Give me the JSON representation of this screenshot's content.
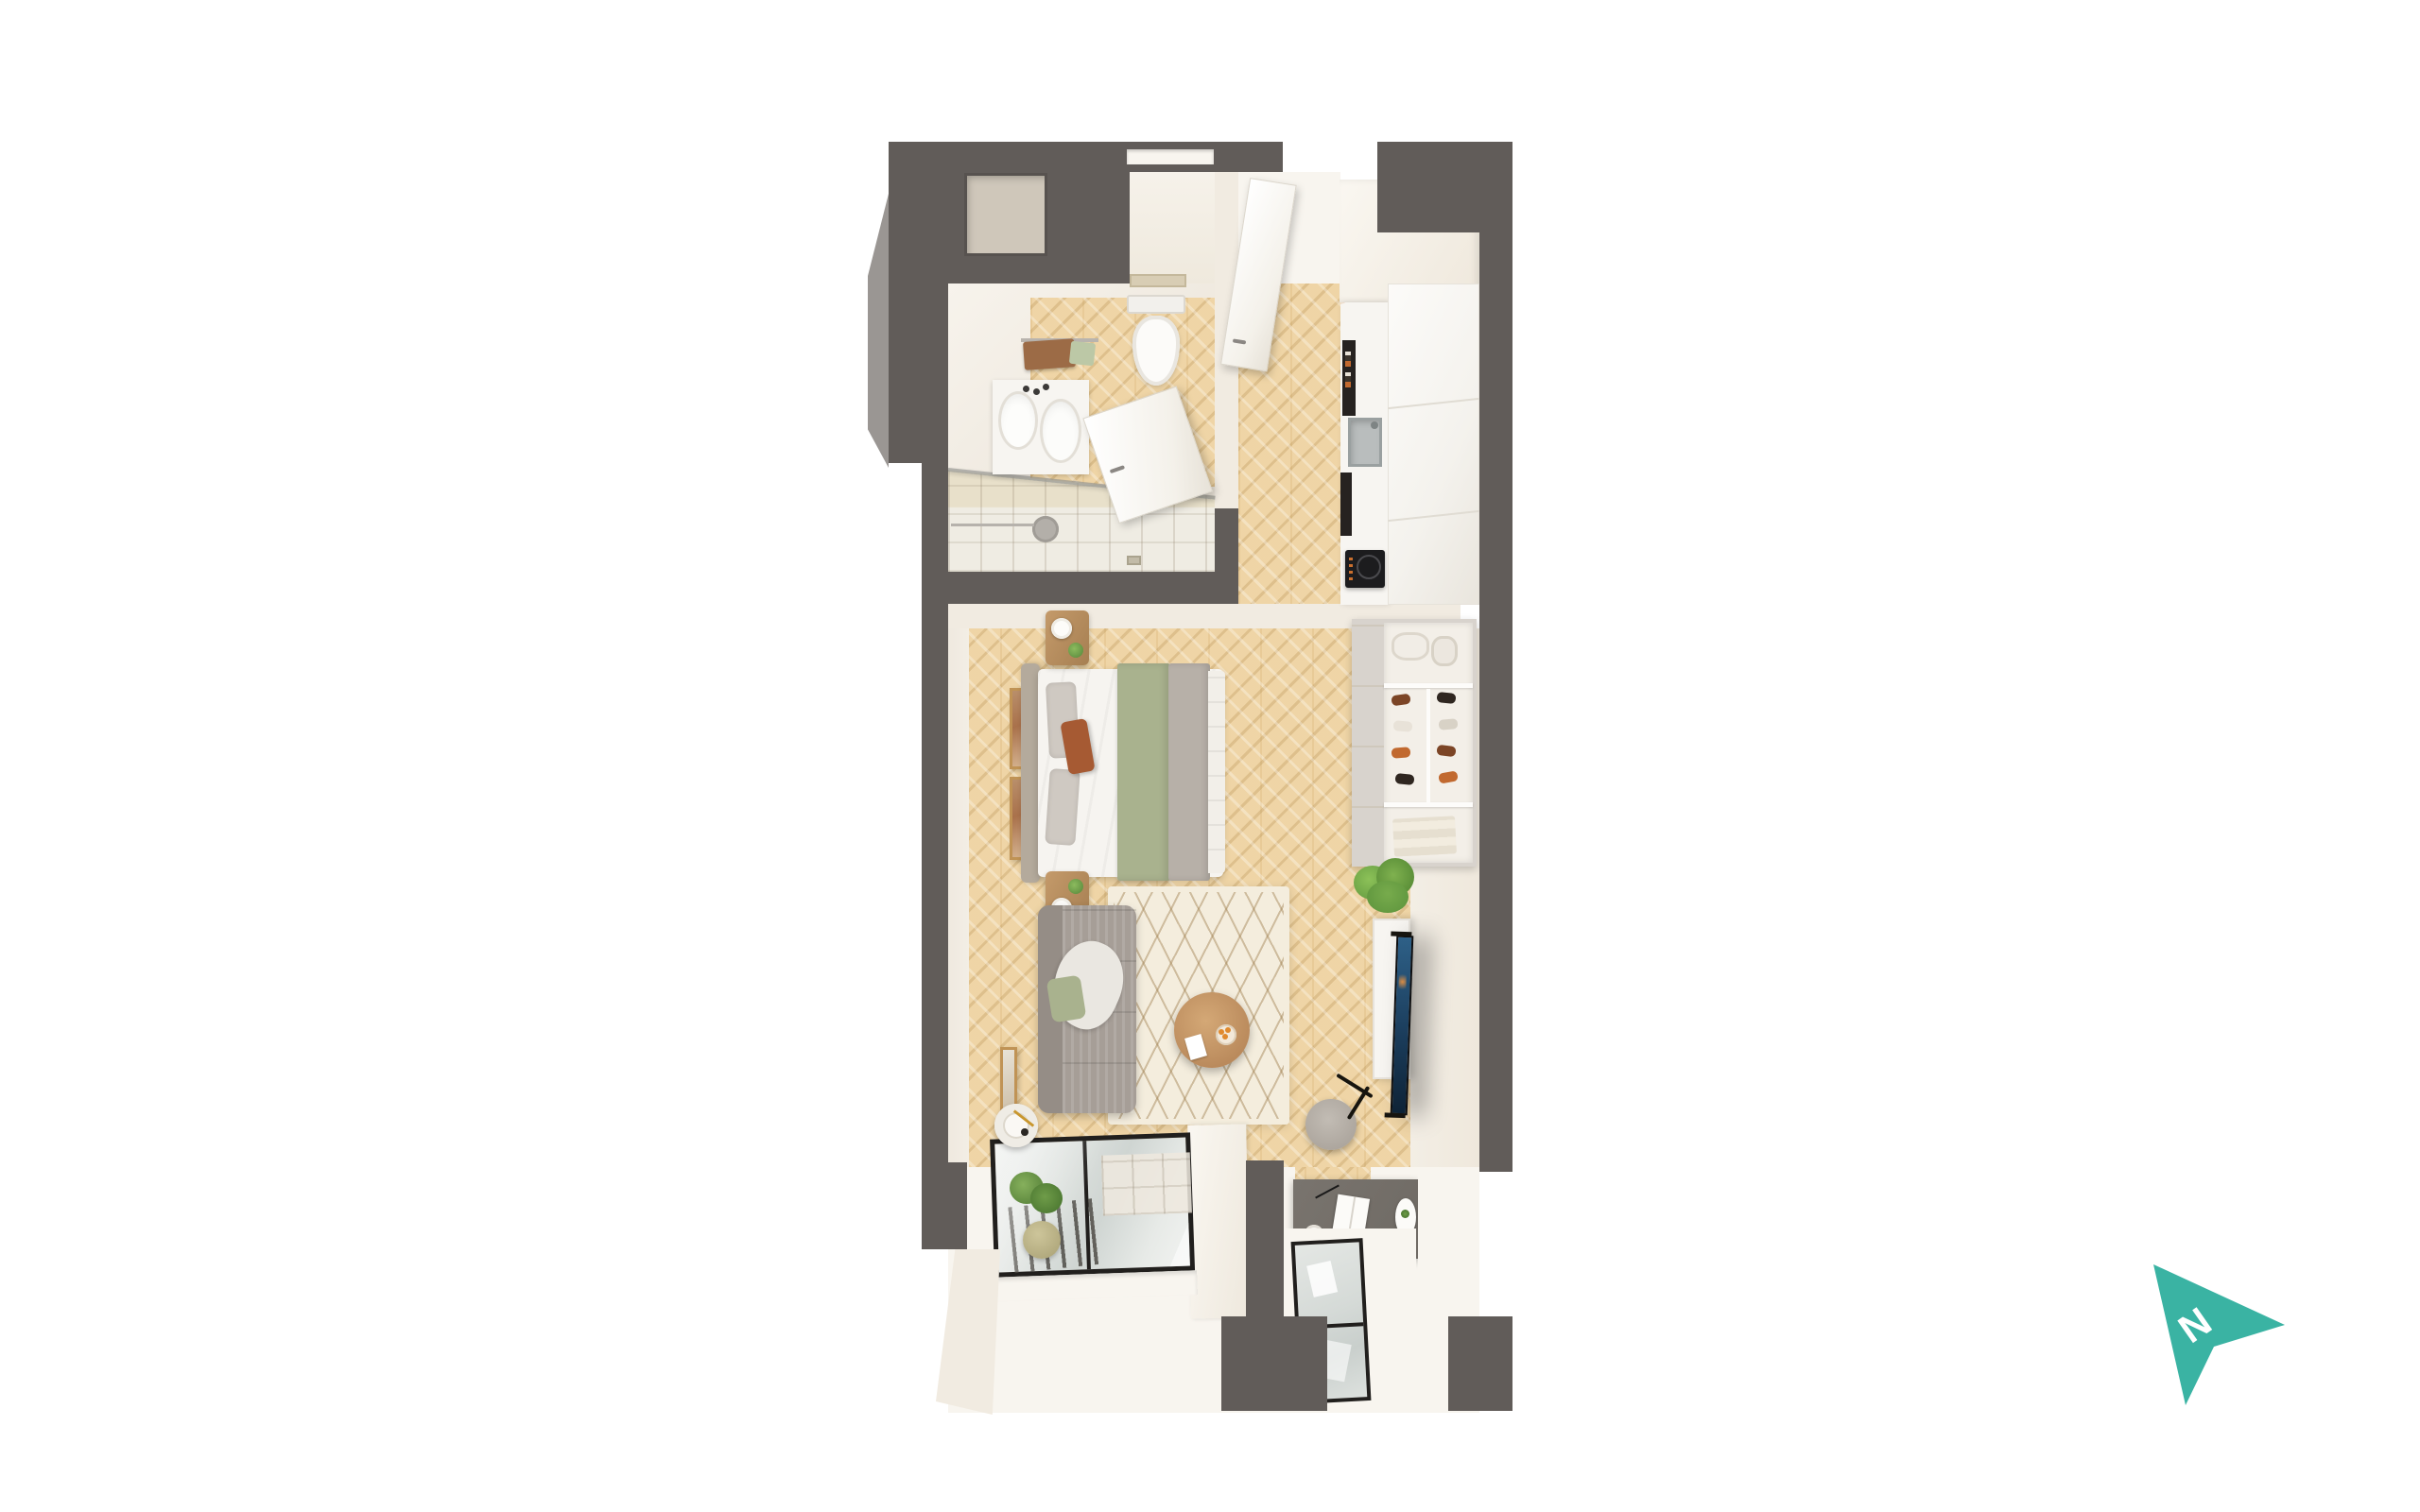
{
  "scene": {
    "type": "3d floor plan render, top-down view",
    "background": "#ffffff"
  },
  "compass": {
    "label": "N",
    "color": "#3ab3a3",
    "label_color": "#ffffff",
    "direction": "pointing upper-right"
  },
  "palette": {
    "wall": "#615c59",
    "wallLight": "#9a9693",
    "creamFace": "#f1ebe1",
    "creamBright": "#f8f5ef",
    "wood": "#eed2a0",
    "woodDark": "#dfbe85",
    "tile": "#e8e0ca",
    "tileLight": "#efece3",
    "rug": "#f4eddd",
    "rugLine": "#c9b28c",
    "teal": "#3ab3a3",
    "glass": "#dfe3e0",
    "frameDark": "#211f1d",
    "sofa": "#a69e97",
    "sofaDark": "#958d86",
    "bedWhite": "#f6f4f0",
    "bedGreen": "#a9b28e",
    "bedGray": "#b7b0a8",
    "headboard": "#b4aa9c",
    "marble": "#f7f5f1",
    "desk": "#6f6a64",
    "woodFurn": "#bb9163",
    "plant": "#77ab4c",
    "plantDark": "#5c933c",
    "screenTop": "#2e6087",
    "screenBot": "#0e2336",
    "orange": "#e08a2e",
    "rust": "#a65a33",
    "towelBrown": "#9c6b46",
    "towelGreen": "#bcc8a6",
    "shoeBrown": "#7c4526",
    "shoeOrange": "#c1692f",
    "shoeDark": "#2f2620"
  },
  "rooms": [
    {
      "name": "bathroom"
    },
    {
      "name": "entry-hall"
    },
    {
      "name": "kitchen"
    },
    {
      "name": "living-sleeping-room"
    },
    {
      "name": "window-bays"
    }
  ],
  "furniture": [
    "entry-door",
    "bathroom-door",
    "toilet",
    "vanity-basin",
    "towel-rail",
    "shower",
    "kitchen-counter",
    "kitchen-sink",
    "induction-hob",
    "tall-cabinets",
    "wardrobe-shelves",
    "shoe-rack",
    "linen-rolls",
    "towel-stack",
    "double-bed",
    "nightstand",
    "table-lamp",
    "wall-art",
    "sofa",
    "area-rug",
    "coffee-table",
    "tv-console",
    "tv",
    "potted-fern",
    "stool",
    "desk",
    "floor-lamp",
    "hanging-plant",
    "glazed-window-bay",
    "window-sill"
  ]
}
